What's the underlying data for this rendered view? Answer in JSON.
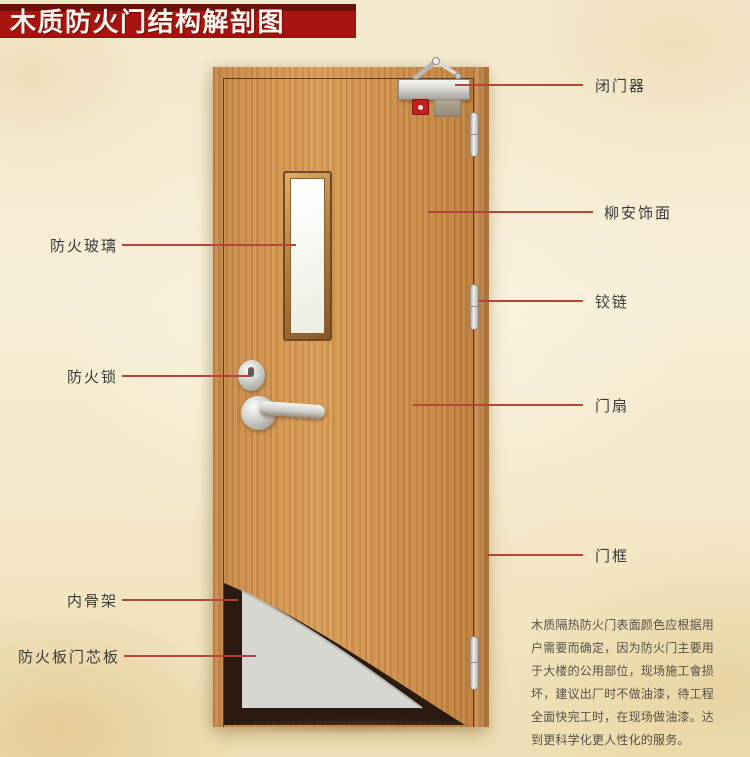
{
  "title": "木质防火门结构解剖图",
  "annotations": {
    "right": [
      {
        "id": "door-closer",
        "text": "闭门器"
      },
      {
        "id": "veneer",
        "text": "柳安饰面"
      },
      {
        "id": "hinge",
        "text": "铰链"
      },
      {
        "id": "door-leaf",
        "text": "门扇"
      },
      {
        "id": "door-frame",
        "text": "门框"
      }
    ],
    "left": [
      {
        "id": "fire-glass",
        "text": "防火玻璃"
      },
      {
        "id": "fire-lock",
        "text": "防火锁"
      },
      {
        "id": "inner-skeleton",
        "text": "内骨架"
      },
      {
        "id": "fire-board-core",
        "text": "防火板门芯板"
      }
    ]
  },
  "description": {
    "text": "木质隔热防火门表面颜色应根据用户需要而确定，因为防火门主要用于大楼的公用部位，现场施工會损坏，建议出厂时不做油漆，待工程全面快完工时，在现场做油漆。达到更科学化更人性化的服务。"
  },
  "colors": {
    "banner_red": "#a81410",
    "banner_top_red": "#6d0f0a",
    "leader_line": "#b4453a",
    "label_text": "#3a3a3a",
    "wood": "#cf9150",
    "cutaway_dark": "#2b1a10",
    "core_gray": "#d6d7d1",
    "background": "#f4e9cd"
  }
}
